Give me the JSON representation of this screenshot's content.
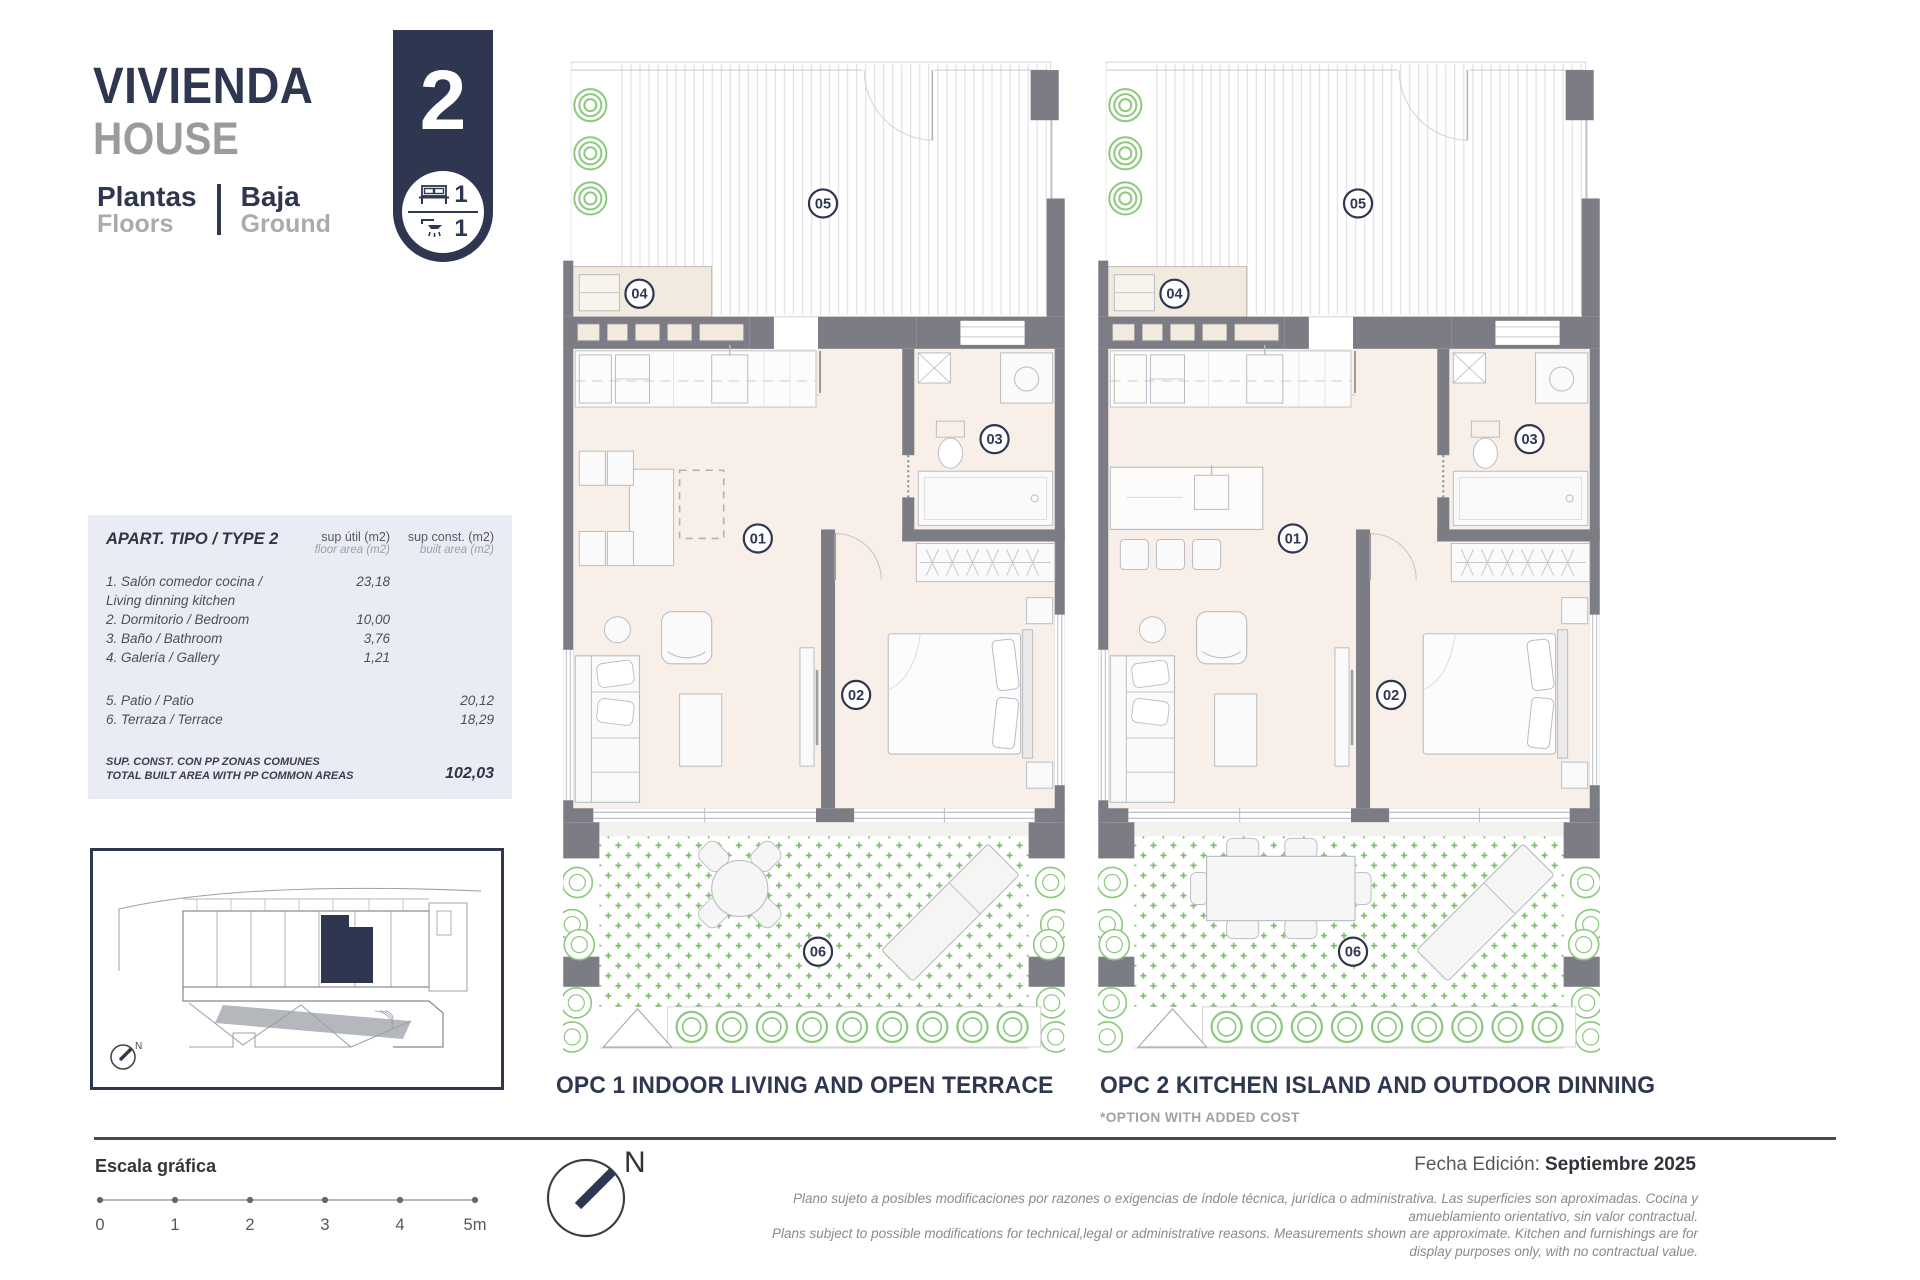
{
  "header": {
    "title_primary": "VIVIENDA",
    "title_secondary": "HOUSE",
    "floors_label": "Plantas",
    "floors_label_en": "Floors",
    "floor_value": "Baja",
    "floor_value_en": "Ground",
    "badge": {
      "number": "2",
      "bedrooms": "1",
      "bathrooms": "1"
    }
  },
  "area_table": {
    "title": "APART. TIPO / TYPE 2",
    "col_util": "sup útil (m2)",
    "col_util_sub": "floor area (m2)",
    "col_const": "sup const. (m2)",
    "col_const_sub": "built area (m2)",
    "rows": [
      {
        "name": "1. Salón comedor cocina / Living dinning kitchen",
        "floor_area": "23,18",
        "built_area": "",
        "group": 1
      },
      {
        "name": "2. Dormitorio / Bedroom",
        "floor_area": "10,00",
        "built_area": "",
        "group": 1
      },
      {
        "name": "3. Baño / Bathroom",
        "floor_area": "3,76",
        "built_area": "",
        "group": 1
      },
      {
        "name": "4. Galería / Gallery",
        "floor_area": "1,21",
        "built_area": "",
        "group": 1
      },
      {
        "name": "5. Patio / Patio",
        "floor_area": "",
        "built_area": "20,12",
        "group": 2
      },
      {
        "name": "6. Terraza / Terrace",
        "floor_area": "",
        "built_area": "18,29",
        "group": 2
      }
    ],
    "total_label_line1": "SUP. CONST. CON PP ZONAS COMUNES",
    "total_label_line2": "TOTAL BUILT AREA WITH PP COMMON AREAS",
    "total_value": "102,03"
  },
  "plans": [
    {
      "variant": "opc1",
      "caption": "OPC 1 INDOOR LIVING AND OPEN TERRACE",
      "note": ""
    },
    {
      "variant": "opc2",
      "caption": "OPC 2 KITCHEN ISLAND AND OUTDOOR DINNING",
      "note": "*OPTION WITH ADDED COST"
    }
  ],
  "room_labels": [
    {
      "key": "living",
      "num": "01"
    },
    {
      "key": "bedroom",
      "num": "02"
    },
    {
      "key": "bathroom",
      "num": "03"
    },
    {
      "key": "gallery",
      "num": "04"
    },
    {
      "key": "patio",
      "num": "05"
    },
    {
      "key": "terrace",
      "num": "06"
    }
  ],
  "footer": {
    "scale_label": "Escala gráfica",
    "scale_ticks": [
      "0",
      "1",
      "2",
      "3",
      "4",
      "5m"
    ],
    "north_label": "N",
    "edition_label": "Fecha Edición:",
    "edition_value": "Septiembre 2025",
    "disclaimer_line1": "Plano sujeto a posibles modificaciones por razones o exigencias de índole técnica,  jurídica o administrativa. Las superficies son aproximadas. Cocina y amueblamiento orientativo, sin valor contractual.",
    "disclaimer_line2": "Plans subject to possible modifications for technical,legal or administrative reasons. Measurements shown are approximate. Kitchen and furnishings are for display purposes only, with no contractual value."
  },
  "colors": {
    "navy": "#2e3650",
    "gray_title": "#9b9b9b",
    "table_bg": "#e9ecf4",
    "wall": "#7c7c85",
    "floor": "#f8efe8",
    "beige": "#f2e9df",
    "green": "#8cc87d",
    "green_plus": "#7bbd6b",
    "furniture_stroke": "#b9bdc3"
  }
}
